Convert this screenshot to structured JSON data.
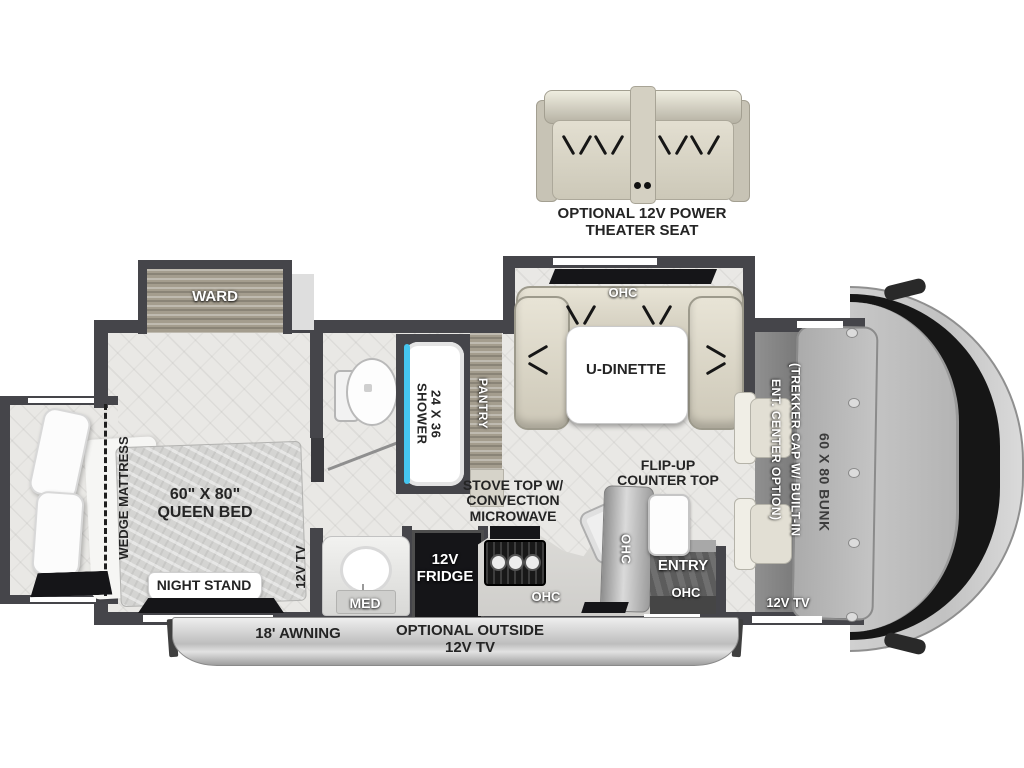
{
  "seat": {
    "line1": "OPTIONAL 12V POWER",
    "line2": "THEATER SEAT"
  },
  "bedroom": {
    "ward": "WARD",
    "wedge": "WEDGE MATTRESS",
    "bed1": "60\" X 80\"",
    "bed2": "QUEEN BED",
    "nightstand": "NIGHT STAND",
    "tv": "12V TV"
  },
  "bath": {
    "shower1": "24 X 36",
    "shower2": "SHOWER",
    "med": "MED"
  },
  "kitchen": {
    "pantry": "PANTRY",
    "fridge1": "12V",
    "fridge2": "FRIDGE",
    "stove1": "STOVE TOP W/",
    "stove2": "CONVECTION",
    "stove3": "MICROWAVE"
  },
  "dinette": {
    "label": "U-DINETTE"
  },
  "entry": {
    "flip1": "FLIP-UP",
    "flip2": "COUNTER TOP",
    "label": "ENTRY"
  },
  "cab": {
    "bunk": "60 X 80 BUNK",
    "trekker1": "(TREKKER CAP W/ BUILT-IN",
    "trekker2": "ENT. CENTER OPTION)",
    "tv": "12V TV"
  },
  "exterior": {
    "awning": "18' AWNING",
    "tv1": "OPTIONAL OUTSIDE",
    "tv2": "12V TV"
  },
  "labels": {
    "ohc": "OHC"
  },
  "colors": {
    "wall": "#45454a",
    "floor": "#e9e8e5",
    "glass": "#45c6f0",
    "cushion": "#ddd9cb",
    "wood": "#a49d8e"
  }
}
